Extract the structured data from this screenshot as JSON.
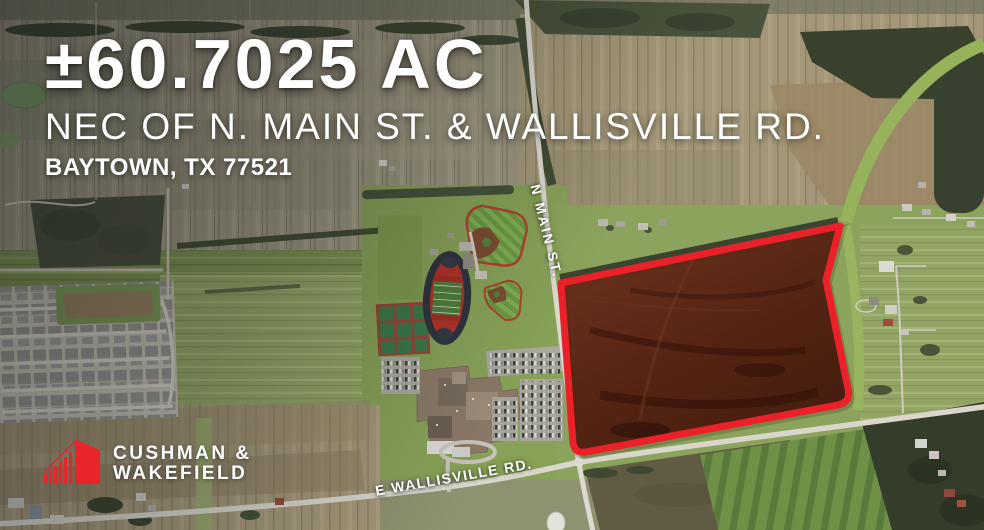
{
  "title": {
    "acreage": "±60.7025 AC",
    "location_line": "NEC OF N. MAIN ST. & WALLISVILLE RD.",
    "city_line": "BAYTOWN, TX 77521"
  },
  "map": {
    "road_labels": {
      "n_main_st": "N MAIN ST.",
      "wallisville_rd": "E WALLISVILLE RD."
    },
    "site_boundary_color": "#ec2028",
    "site_fill_color": "#531c0e"
  },
  "branding": {
    "company_line1": "CUSHMAN &",
    "company_line2": "WAKEFIELD",
    "brand_red": "#e8252b"
  }
}
